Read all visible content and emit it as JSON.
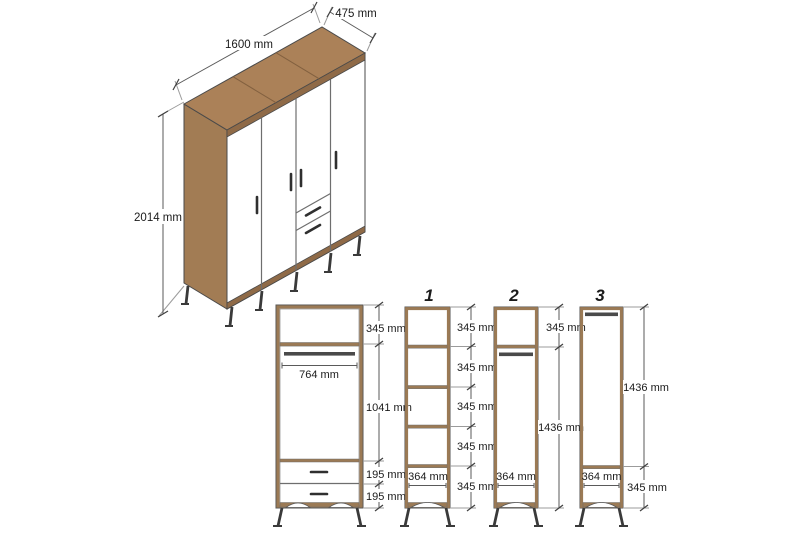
{
  "diagram": {
    "iso_view": {
      "width_label": "1600 mm",
      "depth_label": "475 mm",
      "height_label": "2014 mm"
    },
    "front_view": {
      "top_height": "345 mm",
      "rod_width": "764 mm",
      "middle_height": "1041 mm",
      "drawer_height_1": "195 mm",
      "drawer_height_2": "195 mm"
    },
    "units": [
      {
        "number": "1",
        "width": "364 mm",
        "section_heights": [
          "345 mm",
          "345 mm",
          "345 mm",
          "345 mm",
          "345 mm"
        ]
      },
      {
        "number": "2",
        "width": "364 mm",
        "top_height": "345 mm",
        "hanging_height": "1436 mm"
      },
      {
        "number": "3",
        "width": "364 mm",
        "hanging_height": "1436 mm",
        "bottom_height": "345 mm"
      }
    ],
    "colors": {
      "wood": "#ab8158",
      "wood_side": "#a27c54",
      "wood_edge": "#8f6a47",
      "wood_frame": "#9b7a55",
      "rod": "#4a4a4a",
      "metal_leg": "#3a3a3a",
      "dimension_line": "#5a5a5a",
      "text": "#1b1b1b",
      "background": "#ffffff"
    }
  }
}
